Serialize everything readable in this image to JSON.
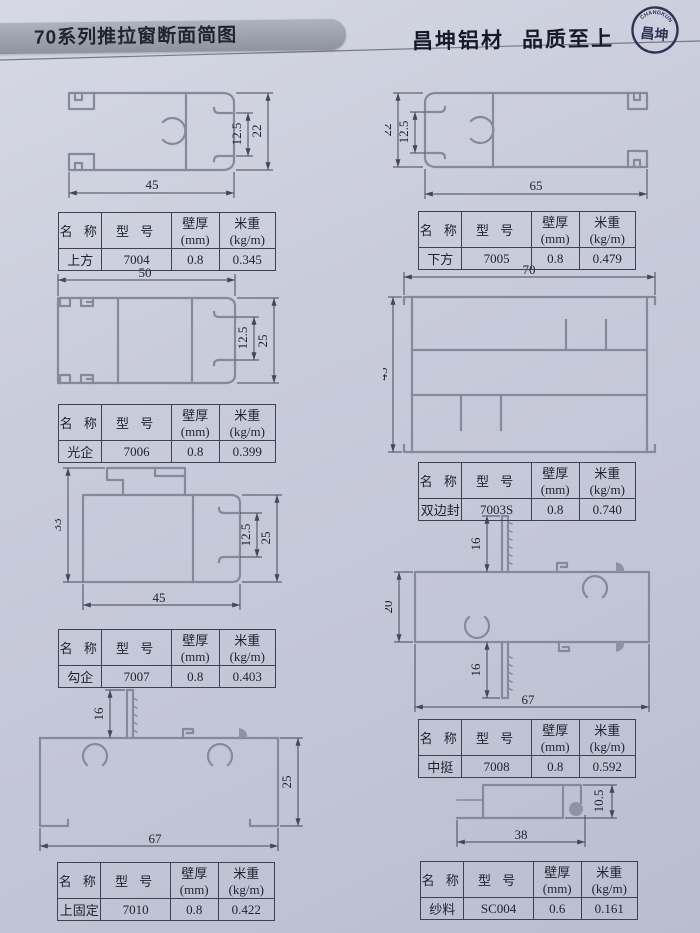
{
  "page": {
    "title": "70系列推拉窗断面简图",
    "brand": "昌坤铝材",
    "slogan": "品质至上",
    "logo_arc": "CHANGKUN",
    "logo_text": "昌坤"
  },
  "colors": {
    "page_bg": "#c9ccdb",
    "banner": "#9aa0ab",
    "profile_line": "#848a9c",
    "dim_line": "#434859",
    "text": "#1e222f",
    "logo_navy": "#2c3654"
  },
  "table_header": {
    "name": "名 称",
    "model": "型 号",
    "thickness": "壁厚(mm)",
    "weight": "米重(kg/m)"
  },
  "profiles": [
    {
      "name": "上方",
      "model": "7004",
      "thickness": "0.8",
      "weight": "0.345",
      "dims": {
        "width": "45",
        "height": "22",
        "inner": "12.5"
      }
    },
    {
      "name": "下方",
      "model": "7005",
      "thickness": "0.8",
      "weight": "0.479",
      "dims": {
        "width": "65",
        "height": "22",
        "inner": "12.5"
      }
    },
    {
      "name": "光企",
      "model": "7006",
      "thickness": "0.8",
      "weight": "0.399",
      "dims": {
        "width": "50",
        "height": "25",
        "inner": "12.5"
      }
    },
    {
      "name": "双边封",
      "model": "7003S",
      "thickness": "0.8",
      "weight": "0.740",
      "dims": {
        "width": "70",
        "height": "45"
      }
    },
    {
      "name": "勾企",
      "model": "7007",
      "thickness": "0.8",
      "weight": "0.403",
      "dims": {
        "width": "45",
        "height_left": "33",
        "height_right": "25",
        "inner": "12.5"
      }
    },
    {
      "name": "中挺",
      "model": "7008",
      "thickness": "0.8",
      "weight": "0.592",
      "dims": {
        "width": "67",
        "height": "20",
        "fin_top": "16",
        "fin_bottom": "16"
      }
    },
    {
      "name": "上固定",
      "model": "7010",
      "thickness": "0.8",
      "weight": "0.422",
      "dims": {
        "width": "67",
        "height": "25",
        "fin": "16"
      }
    },
    {
      "name": "纱料",
      "model": "SC004",
      "thickness": "0.6",
      "weight": "0.161",
      "dims": {
        "width": "38",
        "height": "10.5"
      }
    }
  ]
}
